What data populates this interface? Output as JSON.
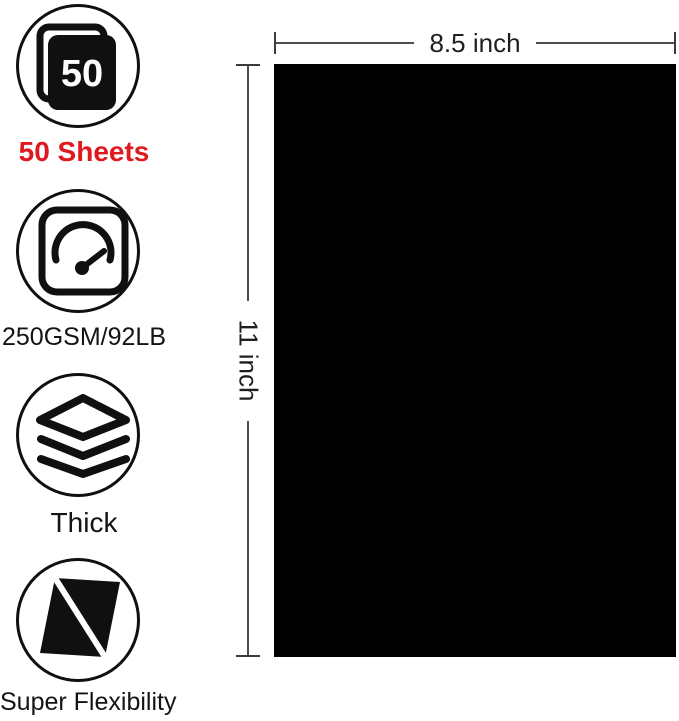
{
  "features": [
    {
      "icon": "sheet-stack-50-icon",
      "icon_text": "50",
      "label": "50 Sheets"
    },
    {
      "icon": "gauge-icon",
      "label": "250GSM/92LB"
    },
    {
      "icon": "layers-icon",
      "label": "Thick"
    },
    {
      "icon": "flex-sheet-icon",
      "label": "Super Flexibility"
    }
  ],
  "paper": {
    "width_label": "8.5 inch",
    "height_label": "11 inch"
  },
  "colors": {
    "accent_red": "#e0191f",
    "icon_black": "#101010",
    "paper_black": "#000000",
    "dimension_line": "#4d4d4d",
    "background": "#ffffff"
  }
}
